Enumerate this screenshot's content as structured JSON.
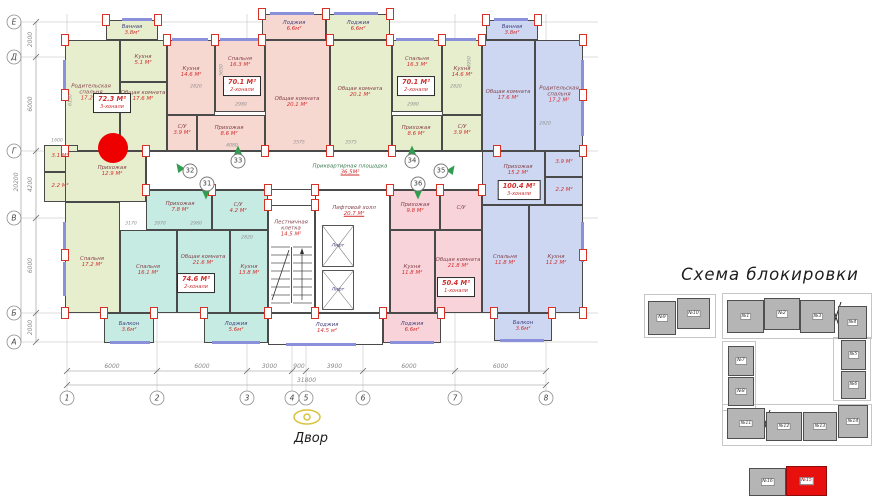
{
  "colors": {
    "green": "#e7eecd",
    "pink": "#f7d8d0",
    "teal": "#c6ebe3",
    "blue": "#cdd7f2",
    "pink2": "#f8d3da",
    "white": "#ffffff",
    "wall": "#4a4a4a",
    "pilaster_red": "#d93025",
    "marker_red": "#ee0000",
    "window": "#8b90da",
    "room_name": "#84424b",
    "room_name_alt": "#41417e",
    "area_red": "#d22f2f",
    "landing_green": "#3a7a4e",
    "dim_gray": "#8a8a8a",
    "grid_gray": "#bcbcbc",
    "block_gray": "#b5b5b5",
    "block_red": "#e8100e",
    "arrow_green": "#2f9e4e",
    "eye_yellow": "#dcc23c"
  },
  "plan": {
    "courtyard_label": "Двор",
    "elevator_label": "Лифт",
    "landing": {
      "name": "Приквартирная площадка",
      "area": "36.5М²",
      "cx": 350,
      "cy": 170
    },
    "marker": {
      "x": 113,
      "y": 148,
      "r": 15
    },
    "axes": {
      "cols": [
        {
          "label": "1",
          "x": 67
        },
        {
          "label": "2",
          "x": 157
        },
        {
          "label": "3",
          "x": 247
        },
        {
          "label": "4",
          "x": 292
        },
        {
          "label": "5",
          "x": 306
        },
        {
          "label": "6",
          "x": 363
        },
        {
          "label": "7",
          "x": 455
        },
        {
          "label": "8",
          "x": 546
        }
      ],
      "rows": [
        {
          "label": "Е",
          "y": 22
        },
        {
          "label": "Д",
          "y": 57
        },
        {
          "label": "Г",
          "y": 151
        },
        {
          "label": "В",
          "y": 218
        },
        {
          "label": "Б",
          "y": 313
        },
        {
          "label": "А",
          "y": 342
        }
      ],
      "col_dims": [
        "6000",
        "6000",
        "3000",
        "900",
        "3900",
        "6000",
        "6000"
      ],
      "col_total": "31800",
      "row_dims": [
        "2000",
        "6000",
        "4200",
        "6000",
        "2000"
      ],
      "row_total": "20200"
    },
    "rooms": [
      {
        "name": "",
        "area": "",
        "x": 146,
        "y": 151,
        "w": 351,
        "h": 39,
        "f": "white",
        "cx": 0,
        "cy": 0
      },
      {
        "name": "Ванная",
        "area": "3.8м²",
        "x": 106,
        "y": 20,
        "w": 52,
        "h": 20,
        "f": "green",
        "cx": 132,
        "cy": 30,
        "nc": "alt"
      },
      {
        "name": "Родительская\nспальня",
        "area": "17.2 М²",
        "x": 65,
        "y": 40,
        "w": 55,
        "h": 111,
        "f": "green",
        "cx": 91,
        "cy": 93
      },
      {
        "name": "Кухня",
        "area": "5.1 М²",
        "x": 120,
        "y": 40,
        "w": 47,
        "h": 42,
        "f": "green",
        "cx": 143,
        "cy": 60
      },
      {
        "name": "Общая комната",
        "area": "17.6 М²",
        "x": 120,
        "y": 82,
        "w": 47,
        "h": 69,
        "f": "green",
        "cx": 143,
        "cy": 96
      },
      {
        "name": "",
        "area": "3.1 М²",
        "x": 44,
        "y": 145,
        "w": 34,
        "h": 27,
        "f": "green",
        "cx": 60,
        "cy": 156
      },
      {
        "name": "",
        "area": "2.2 М²",
        "x": 44,
        "y": 172,
        "w": 34,
        "h": 30,
        "f": "green",
        "cx": 60,
        "cy": 186
      },
      {
        "name": "Прихожая",
        "area": "12.9 М²",
        "x": 65,
        "y": 151,
        "w": 81,
        "h": 51,
        "f": "green",
        "cx": 112,
        "cy": 171
      },
      {
        "name": "Спальня",
        "area": "17.2 М²",
        "x": 65,
        "y": 202,
        "w": 55,
        "h": 111,
        "f": "green",
        "cx": 92,
        "cy": 262
      },
      {
        "name": "Кухня",
        "area": "14.6 М²",
        "x": 167,
        "y": 40,
        "w": 48,
        "h": 75,
        "f": "pink",
        "cx": 191,
        "cy": 72
      },
      {
        "name": "Спальня",
        "area": "16.3 М²",
        "x": 215,
        "y": 40,
        "w": 50,
        "h": 72,
        "f": "pink",
        "cx": 240,
        "cy": 62
      },
      {
        "name": "Общая комната",
        "area": "20.1 М²",
        "x": 265,
        "y": 40,
        "w": 65,
        "h": 111,
        "f": "pink",
        "cx": 297,
        "cy": 102
      },
      {
        "name": "Лоджия",
        "area": "6.6м²",
        "x": 262,
        "y": 14,
        "w": 64,
        "h": 26,
        "f": "pink",
        "cx": 294,
        "cy": 26,
        "nc": "alt"
      },
      {
        "name": "С/У",
        "area": "3.9 М²",
        "x": 167,
        "y": 115,
        "w": 30,
        "h": 36,
        "f": "pink",
        "cx": 182,
        "cy": 130
      },
      {
        "name": "Прихожая",
        "area": "8.6 М²",
        "x": 197,
        "y": 115,
        "w": 68,
        "h": 36,
        "f": "pink",
        "cx": 229,
        "cy": 131
      },
      {
        "name": "Лоджия",
        "area": "6.6м²",
        "x": 326,
        "y": 14,
        "w": 64,
        "h": 26,
        "f": "green",
        "cx": 358,
        "cy": 26,
        "nc": "alt"
      },
      {
        "name": "Общая комната",
        "area": "20.1 М²",
        "x": 330,
        "y": 40,
        "w": 62,
        "h": 111,
        "f": "green",
        "cx": 360,
        "cy": 92
      },
      {
        "name": "Спальня",
        "area": "16.3 М²",
        "x": 392,
        "y": 40,
        "w": 50,
        "h": 72,
        "f": "green",
        "cx": 417,
        "cy": 62
      },
      {
        "name": "Кухня",
        "area": "14.6 М²",
        "x": 442,
        "y": 40,
        "w": 40,
        "h": 75,
        "f": "green",
        "cx": 462,
        "cy": 72
      },
      {
        "name": "Прихожая",
        "area": "8.6 М²",
        "x": 392,
        "y": 115,
        "w": 50,
        "h": 36,
        "f": "green",
        "cx": 416,
        "cy": 131
      },
      {
        "name": "С/У",
        "area": "3.9 М²",
        "x": 442,
        "y": 115,
        "w": 40,
        "h": 36,
        "f": "green",
        "cx": 462,
        "cy": 130
      },
      {
        "name": "Ванная",
        "area": "3.8м²",
        "x": 486,
        "y": 20,
        "w": 52,
        "h": 20,
        "f": "blue",
        "cx": 512,
        "cy": 30,
        "nc": "alt"
      },
      {
        "name": "Общая комната",
        "area": "17.6 М²",
        "x": 482,
        "y": 40,
        "w": 53,
        "h": 111,
        "f": "blue",
        "cx": 508,
        "cy": 95
      },
      {
        "name": "Родительская\nспальня",
        "area": "17.2 М²",
        "x": 535,
        "y": 40,
        "w": 48,
        "h": 111,
        "f": "blue",
        "cx": 559,
        "cy": 95
      },
      {
        "name": "Прихожая",
        "area": "15.2 М²",
        "x": 482,
        "y": 151,
        "w": 63,
        "h": 54,
        "f": "blue",
        "cx": 518,
        "cy": 170
      },
      {
        "name": "",
        "area": "3.9 М²",
        "x": 545,
        "y": 151,
        "w": 38,
        "h": 26,
        "f": "blue",
        "cx": 564,
        "cy": 162
      },
      {
        "name": "",
        "area": "2.2 М²",
        "x": 545,
        "y": 177,
        "w": 38,
        "h": 28,
        "f": "blue",
        "cx": 564,
        "cy": 190
      },
      {
        "name": "Спальня",
        "area": "11.8 М²",
        "x": 482,
        "y": 205,
        "w": 47,
        "h": 108,
        "f": "blue",
        "cx": 505,
        "cy": 260
      },
      {
        "name": "Кухня",
        "area": "11.2 М²",
        "x": 529,
        "y": 205,
        "w": 54,
        "h": 108,
        "f": "blue",
        "cx": 556,
        "cy": 260
      },
      {
        "name": "Балкон",
        "area": "3.6м²",
        "x": 494,
        "y": 313,
        "w": 58,
        "h": 28,
        "f": "blue",
        "cx": 523,
        "cy": 326,
        "nc": "alt"
      },
      {
        "name": "Прихожая",
        "area": "7.8 М²",
        "x": 146,
        "y": 190,
        "w": 66,
        "h": 40,
        "f": "teal",
        "cx": 180,
        "cy": 207
      },
      {
        "name": "С/У",
        "area": "4.2 М²",
        "x": 212,
        "y": 190,
        "w": 56,
        "h": 40,
        "f": "teal",
        "cx": 238,
        "cy": 208
      },
      {
        "name": "Спальня",
        "area": "16.1 М²",
        "x": 120,
        "y": 230,
        "w": 57,
        "h": 83,
        "f": "teal",
        "cx": 148,
        "cy": 270
      },
      {
        "name": "Общая комната",
        "area": "21.6 М²",
        "x": 177,
        "y": 230,
        "w": 53,
        "h": 83,
        "f": "teal",
        "cx": 203,
        "cy": 260
      },
      {
        "name": "Кухня",
        "area": "13.8 М²",
        "x": 230,
        "y": 230,
        "w": 38,
        "h": 83,
        "f": "teal",
        "cx": 249,
        "cy": 270
      },
      {
        "name": "Балкон",
        "area": "3.6м²",
        "x": 104,
        "y": 313,
        "w": 50,
        "h": 30,
        "f": "teal",
        "cx": 129,
        "cy": 327,
        "nc": "alt"
      },
      {
        "name": "Лоджия",
        "area": "5.6м²",
        "x": 204,
        "y": 313,
        "w": 64,
        "h": 30,
        "f": "teal",
        "cx": 236,
        "cy": 327,
        "nc": "alt"
      },
      {
        "name": "Лестничная\nклетка",
        "area": "14.5 М²",
        "x": 268,
        "y": 205,
        "w": 47,
        "h": 108,
        "f": "white",
        "cx": 291,
        "cy": 229
      },
      {
        "name": "Лифтовой холл",
        "area": "20.7 М²",
        "x": 315,
        "y": 190,
        "w": 75,
        "h": 123,
        "f": "white",
        "cx": 354,
        "cy": 211,
        "ul": true
      },
      {
        "name": "Лоджия",
        "area": "14.5 м²",
        "x": 268,
        "y": 313,
        "w": 115,
        "h": 32,
        "f": "white",
        "cx": 327,
        "cy": 328,
        "nc": "alt"
      },
      {
        "name": "Прихожая",
        "area": "9.8 М²",
        "x": 390,
        "y": 190,
        "w": 50,
        "h": 40,
        "f": "pink2",
        "cx": 415,
        "cy": 208
      },
      {
        "name": "С/У",
        "area": "",
        "x": 440,
        "y": 190,
        "w": 42,
        "h": 40,
        "f": "pink2",
        "cx": 461,
        "cy": 208
      },
      {
        "name": "Кухня",
        "area": "11.8 М²",
        "x": 390,
        "y": 230,
        "w": 45,
        "h": 83,
        "f": "pink2",
        "cx": 412,
        "cy": 270
      },
      {
        "name": "Общая комната",
        "area": "21.8 М²",
        "x": 435,
        "y": 230,
        "w": 47,
        "h": 83,
        "f": "pink2",
        "cx": 458,
        "cy": 263
      },
      {
        "name": "Лоджия",
        "area": "6.6м²",
        "x": 383,
        "y": 313,
        "w": 58,
        "h": 30,
        "f": "pink2",
        "cx": 412,
        "cy": 327,
        "nc": "alt"
      }
    ],
    "units": [
      {
        "area": "72.3 М²",
        "type": "3-хонали",
        "cx": 112,
        "cy": 103
      },
      {
        "area": "70.1 М²",
        "type": "2-хонали",
        "cx": 242,
        "cy": 86
      },
      {
        "area": "70.1 М²",
        "type": "2-хонали",
        "cx": 416,
        "cy": 86
      },
      {
        "area": "100.4 М²",
        "type": "3-хонали",
        "cx": 519,
        "cy": 190
      },
      {
        "area": "74.6 М²",
        "type": "2-хонали",
        "cx": 196,
        "cy": 283
      },
      {
        "area": "50.4 М²",
        "type": "1-хонали",
        "cx": 456,
        "cy": 287
      }
    ],
    "entrances": [
      {
        "num": "32",
        "x": 190,
        "y": 171,
        "adx": -11,
        "ady": -4,
        "rot": -35
      },
      {
        "num": "31",
        "x": 207,
        "y": 184,
        "adx": -1,
        "ady": 11,
        "rot": 180
      },
      {
        "num": "33",
        "x": 238,
        "y": 161,
        "adx": 0,
        "ady": -11,
        "rot": 0
      },
      {
        "num": "34",
        "x": 412,
        "y": 161,
        "adx": 0,
        "ady": -11,
        "rot": 0
      },
      {
        "num": "35",
        "x": 441,
        "y": 171,
        "adx": 11,
        "ady": -2,
        "rot": 35
      },
      {
        "num": "36",
        "x": 418,
        "y": 184,
        "adx": 0,
        "ady": 11,
        "rot": 180
      }
    ],
    "small_dims": [
      {
        "t": "2820",
        "x": 196,
        "y": 87,
        "r": 0
      },
      {
        "t": "2980",
        "x": 241,
        "y": 105,
        "r": 0
      },
      {
        "t": "3575",
        "x": 299,
        "y": 143,
        "r": 0
      },
      {
        "t": "3575",
        "x": 351,
        "y": 143,
        "r": 0
      },
      {
        "t": "2980",
        "x": 413,
        "y": 105,
        "r": 0
      },
      {
        "t": "2820",
        "x": 456,
        "y": 87,
        "r": 0
      },
      {
        "t": "4080",
        "x": 232,
        "y": 146,
        "r": 0
      },
      {
        "t": "3170",
        "x": 131,
        "y": 224,
        "r": 0
      },
      {
        "t": "3970",
        "x": 160,
        "y": 224,
        "r": 0
      },
      {
        "t": "2980",
        "x": 196,
        "y": 224,
        "r": 0
      },
      {
        "t": "2820",
        "x": 247,
        "y": 238,
        "r": 0
      },
      {
        "t": "6150",
        "x": 71,
        "y": 100,
        "r": -90
      },
      {
        "t": "4950",
        "x": 470,
        "y": 62,
        "r": -90
      },
      {
        "t": "2820",
        "x": 545,
        "y": 124,
        "r": 0
      },
      {
        "t": "1600",
        "x": 57,
        "y": 141,
        "r": 0
      },
      {
        "t": "5650",
        "x": 222,
        "y": 70,
        "r": -90
      }
    ]
  },
  "blocking_scheme": {
    "title": "Схема блокировки",
    "blocks": [
      {
        "label": "№9",
        "x": 648,
        "y": 301,
        "w": 28,
        "h": 34
      },
      {
        "label": "№10",
        "x": 677,
        "y": 298,
        "w": 33,
        "h": 31
      },
      {
        "label": "№1",
        "x": 727,
        "y": 300,
        "w": 37,
        "h": 33
      },
      {
        "label": "№2",
        "x": 764,
        "y": 298,
        "w": 36,
        "h": 32
      },
      {
        "label": "№3",
        "x": 800,
        "y": 300,
        "w": 35,
        "h": 33
      },
      {
        "label": "№4",
        "x": 838,
        "y": 306,
        "w": 29,
        "h": 33
      },
      {
        "label": "№5",
        "x": 841,
        "y": 340,
        "w": 25,
        "h": 30
      },
      {
        "label": "№6",
        "x": 841,
        "y": 371,
        "w": 25,
        "h": 28
      },
      {
        "label": "№7",
        "x": 728,
        "y": 346,
        "w": 26,
        "h": 30
      },
      {
        "label": "№8",
        "x": 728,
        "y": 377,
        "w": 26,
        "h": 29
      },
      {
        "label": "№11",
        "x": 727,
        "y": 408,
        "w": 38,
        "h": 31
      },
      {
        "label": "№12",
        "x": 766,
        "y": 412,
        "w": 36,
        "h": 29
      },
      {
        "label": "№13",
        "x": 803,
        "y": 412,
        "w": 34,
        "h": 29
      },
      {
        "label": "№14",
        "x": 838,
        "y": 405,
        "w": 30,
        "h": 33
      }
    ],
    "legend": [
      {
        "label": "№16",
        "x": 749,
        "y": 468,
        "w": 37,
        "h": 28,
        "red": false
      },
      {
        "label": "№15",
        "x": 786,
        "y": 466,
        "w": 41,
        "h": 30,
        "red": true
      }
    ]
  }
}
